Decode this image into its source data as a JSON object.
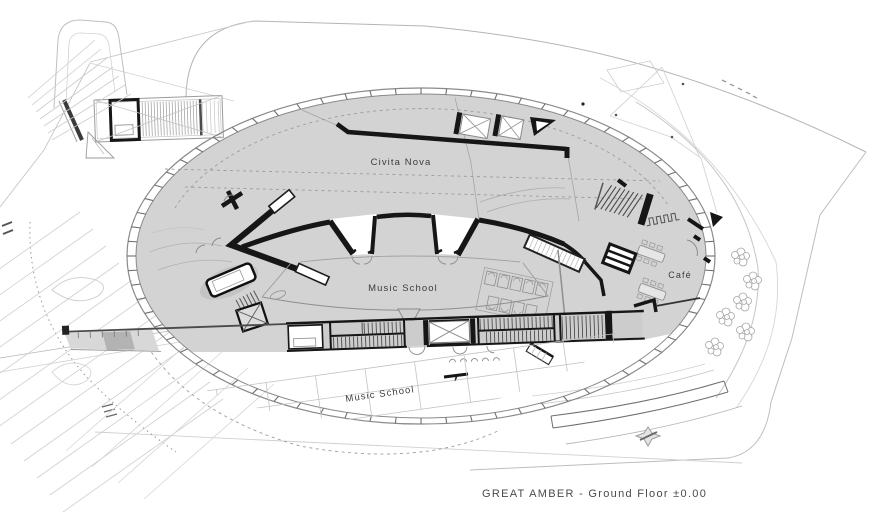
{
  "caption": "GREAT AMBER - Ground Floor ±0.00",
  "labels": {
    "civita_nova": "Civita Nova",
    "music_school_upper": "Music School",
    "cafe": "Café",
    "music_school_lower": "Music School"
  },
  "colors": {
    "background": "#ffffff",
    "interior_fill": "#d3d3d3",
    "band_fill": "#cccccc",
    "wall": "#161616",
    "medium_line": "#8a8a8a",
    "context_line": "#c6c6c6",
    "label_text": "#3d3d3d",
    "caption_text": "#4a4a4a"
  }
}
